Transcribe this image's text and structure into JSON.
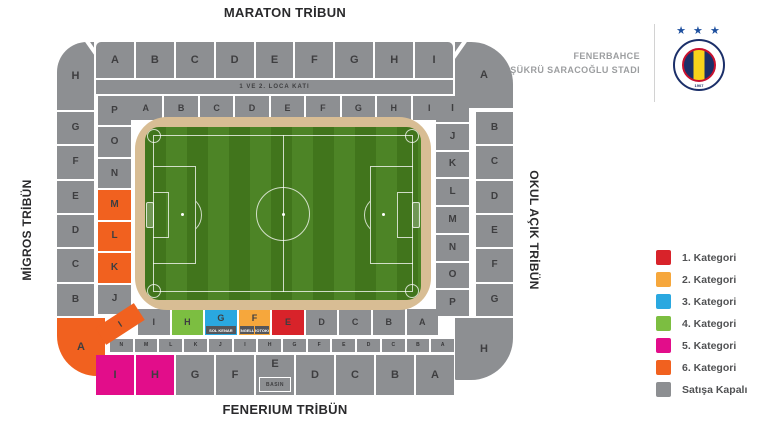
{
  "header": {
    "club_name": "FENERBAHCE",
    "stadium_name": "ŞÜKRÜ SARACOĞLU STADI",
    "crest_stars": "★ ★ ★",
    "crest_year": "1907"
  },
  "tribunes": {
    "maraton": "MARATON TRİBUN",
    "fenerium": "FENERIUM TRİBÜN",
    "migros": "MİGROS TRİBÜN",
    "okul": "OKUL AÇIK TRİBÜN"
  },
  "labels": {
    "loca": "1 VE 2. LOCA KATI",
    "press": "BASIN"
  },
  "colors": {
    "cat1": "#d8232a",
    "cat2": "#f6a73c",
    "cat3": "#2aa8e0",
    "cat4": "#7cbe41",
    "cat5": "#e20d8a",
    "cat6": "#f1611f",
    "closed": "#8d8f92",
    "pitch_dark": "#41751c",
    "pitch_light": "#4d8426",
    "track": "#d8bd94"
  },
  "legend": {
    "items": [
      {
        "label": "1. Kategori",
        "cat": "cat1"
      },
      {
        "label": "2. Kategori",
        "cat": "cat2"
      },
      {
        "label": "3. Kategori",
        "cat": "cat3"
      },
      {
        "label": "4. Kategori",
        "cat": "cat4"
      },
      {
        "label": "5. Kategori",
        "cat": "cat5"
      },
      {
        "label": "6. Kategori",
        "cat": "cat6"
      },
      {
        "label": "Satışa Kapalı",
        "cat": "closed"
      }
    ]
  },
  "sections": {
    "top_outer": [
      {
        "label": "A"
      },
      {
        "label": "B"
      },
      {
        "label": "C"
      },
      {
        "label": "D"
      },
      {
        "label": "E"
      },
      {
        "label": "F"
      },
      {
        "label": "G"
      },
      {
        "label": "H"
      },
      {
        "label": "I"
      }
    ],
    "top_inner": [
      {
        "label": "A"
      },
      {
        "label": "B"
      },
      {
        "label": "C"
      },
      {
        "label": "D"
      },
      {
        "label": "E"
      },
      {
        "label": "F"
      },
      {
        "label": "G"
      },
      {
        "label": "H"
      },
      {
        "label": "I"
      }
    ],
    "left_outer": [
      {
        "label": "G"
      },
      {
        "label": "F"
      },
      {
        "label": "E"
      },
      {
        "label": "D"
      },
      {
        "label": "C"
      },
      {
        "label": "B"
      }
    ],
    "left_inner": [
      {
        "label": "P"
      },
      {
        "label": "O"
      },
      {
        "label": "N"
      },
      {
        "label": "M",
        "cat": "cat6"
      },
      {
        "label": "L",
        "cat": "cat6"
      },
      {
        "label": "K",
        "cat": "cat6"
      },
      {
        "label": "J"
      }
    ],
    "right_inner": [
      {
        "label": "I"
      },
      {
        "label": "J"
      },
      {
        "label": "K"
      },
      {
        "label": "L"
      },
      {
        "label": "M"
      },
      {
        "label": "N"
      },
      {
        "label": "O"
      },
      {
        "label": "P"
      }
    ],
    "right_outer": [
      {
        "label": "B"
      },
      {
        "label": "C"
      },
      {
        "label": "D"
      },
      {
        "label": "E"
      },
      {
        "label": "F"
      },
      {
        "label": "G"
      }
    ],
    "corner_top_left": {
      "label": "H"
    },
    "corner_top_right": {
      "label": "A"
    },
    "corner_bottom_left": {
      "label": "A"
    },
    "corner_bottom_right": {
      "label": "H"
    },
    "wedge_bottom_left": {
      "label": "I"
    },
    "bottom_inner": [
      {
        "label": "I"
      },
      {
        "label": "H",
        "cat": "cat4"
      },
      {
        "label": "G",
        "cat": "cat3",
        "micro": [
          "SOL KENAR"
        ]
      },
      {
        "label": "F",
        "cat": "cat2",
        "micro": [
          "ENGELLİ",
          "PROTOKOL"
        ]
      },
      {
        "label": "E",
        "cat": "cat1"
      },
      {
        "label": "D"
      },
      {
        "label": "C"
      },
      {
        "label": "B"
      },
      {
        "label": "A"
      }
    ],
    "bottom_small": [
      {
        "label": "N"
      },
      {
        "label": "M"
      },
      {
        "label": "L"
      },
      {
        "label": "K"
      },
      {
        "label": "J"
      },
      {
        "label": "I"
      },
      {
        "label": "H"
      },
      {
        "label": "G"
      },
      {
        "label": "F"
      },
      {
        "label": "E"
      },
      {
        "label": "D"
      },
      {
        "label": "C"
      },
      {
        "label": "B"
      },
      {
        "label": "A"
      }
    ],
    "bottom_outer": [
      {
        "label": "I",
        "cat": "cat5"
      },
      {
        "label": "H",
        "cat": "cat5"
      },
      {
        "label": "G"
      },
      {
        "label": "F"
      },
      {
        "label": "E",
        "sub": "BASIN"
      },
      {
        "label": "D"
      },
      {
        "label": "C"
      },
      {
        "label": "B"
      },
      {
        "label": "A"
      }
    ]
  }
}
